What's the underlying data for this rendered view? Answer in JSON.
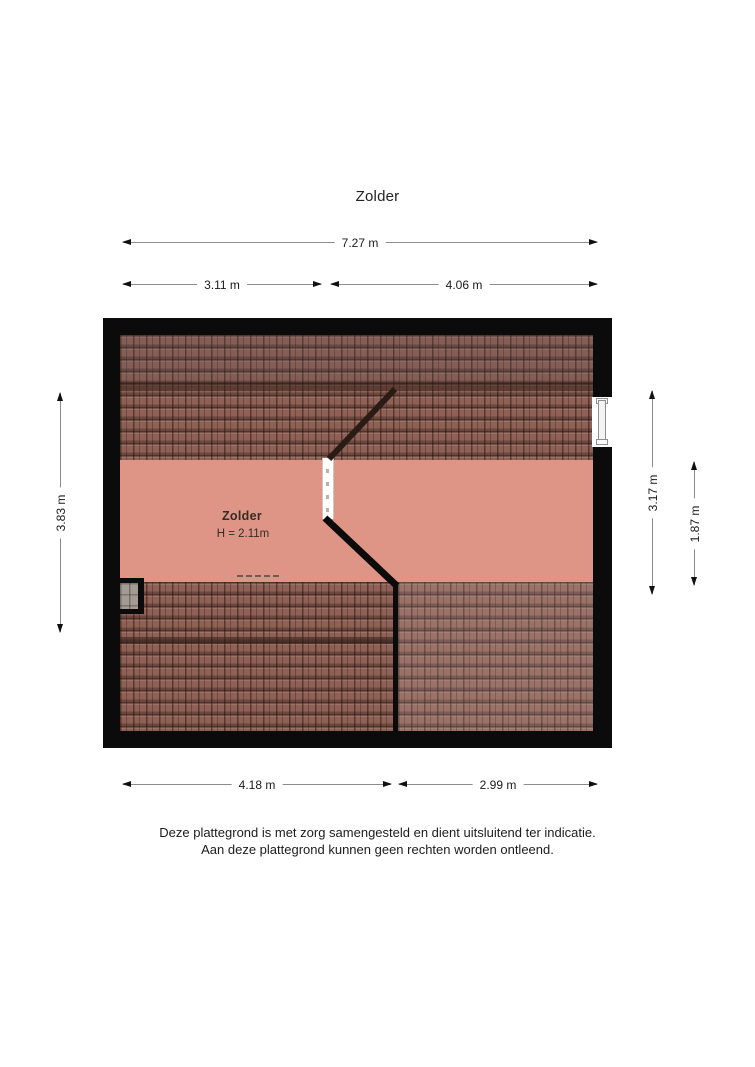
{
  "page": {
    "title": "Zolder",
    "disclaimer_line1": "Deze plattegrond is met zorg samengesteld en dient uitsluitend ter indicatie.",
    "disclaimer_line2": "Aan deze plattegrond kunnen geen rechten worden ontleend."
  },
  "room": {
    "name": "Zolder",
    "height_label": "H = 2.11m"
  },
  "dimensions": {
    "top_total": "7.27 m",
    "top_left": "3.11 m",
    "top_right": "4.06 m",
    "left": "3.83 m",
    "right_outer": "3.17 m",
    "right_inner": "1.87 m",
    "bottom_left": "4.18 m",
    "bottom_right": "2.99 m"
  },
  "colors": {
    "wall": "#0b0b0b",
    "floor": "#de9586",
    "roof_tile": "#8f6156",
    "roof_ridge": "#4f342a",
    "dimension_line": "#8c8c8c",
    "dimension_arrow": "#111111"
  }
}
